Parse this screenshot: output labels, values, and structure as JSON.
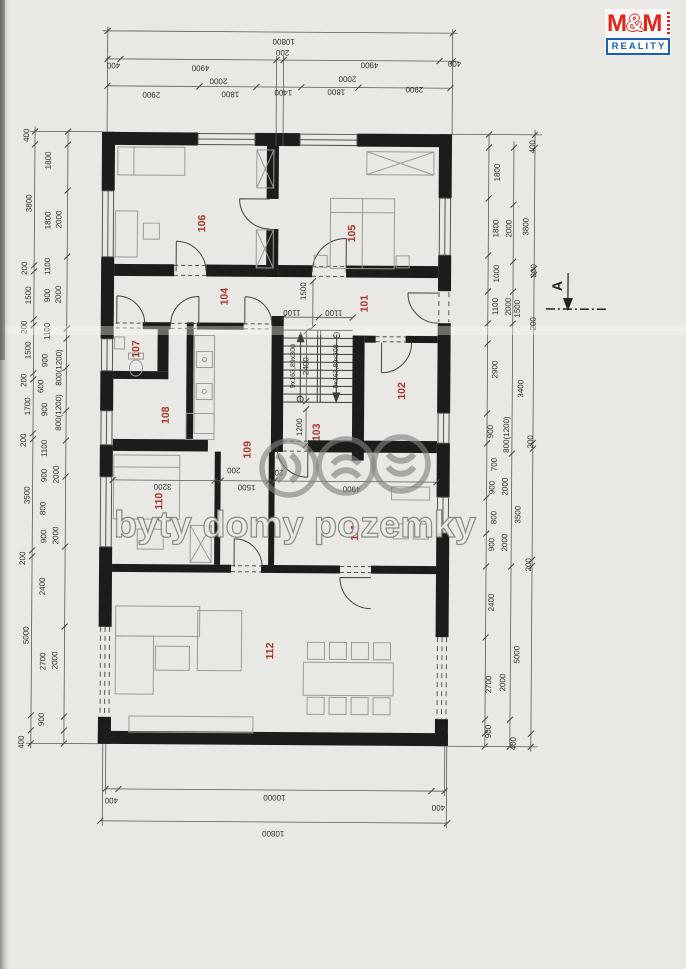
{
  "logo": {
    "brand": "M&M",
    "product": "REALITY"
  },
  "watermark": {
    "text": "byty domy pozemky"
  },
  "section": {
    "label": "A"
  },
  "stairs_note": "9x163,89x300",
  "colors": {
    "wall": "#1c1c1a",
    "room_label": "#a63528",
    "dim_text": "#2e2e2c",
    "brand_red": "#e0251b",
    "brand_blue": "#1b5fb0",
    "watermark_gray": "#8c8c8a",
    "paper": "#e9e8e5"
  },
  "rooms": [
    {
      "n": "101",
      "x": 364,
      "y": 303
    },
    {
      "n": "102",
      "x": 402,
      "y": 390
    },
    {
      "n": "103",
      "x": 317,
      "y": 432
    },
    {
      "n": "104",
      "x": 224,
      "y": 297
    },
    {
      "n": "105",
      "x": 351,
      "y": 233
    },
    {
      "n": "106",
      "x": 201,
      "y": 224
    },
    {
      "n": "107",
      "x": 136,
      "y": 350
    },
    {
      "n": "108",
      "x": 166,
      "y": 416
    },
    {
      "n": "109",
      "x": 248,
      "y": 450
    },
    {
      "n": "110",
      "x": 160,
      "y": 502
    },
    {
      "n": "111",
      "x": 356,
      "y": 532
    },
    {
      "n": "112",
      "x": 272,
      "y": 651
    }
  ],
  "dims": [
    {
      "t": "10800",
      "x": 281,
      "y": 41,
      "r": 180
    },
    {
      "t": "400",
      "x": 111,
      "y": 66,
      "r": 180
    },
    {
      "t": "4900",
      "x": 198,
      "y": 68,
      "r": 180
    },
    {
      "t": "200",
      "x": 280,
      "y": 52,
      "r": 180
    },
    {
      "t": "4900",
      "x": 367,
      "y": 64,
      "r": 180
    },
    {
      "t": "400",
      "x": 452,
      "y": 62,
      "r": 180
    },
    {
      "t": "2900",
      "x": 149,
      "y": 95,
      "r": 180
    },
    {
      "t": "2000",
      "x": 216,
      "y": 81,
      "r": 180
    },
    {
      "t": "1800",
      "x": 228,
      "y": 94,
      "r": 180
    },
    {
      "t": "1400",
      "x": 281,
      "y": 92,
      "r": 180
    },
    {
      "t": "1800",
      "x": 334,
      "y": 91,
      "r": 180
    },
    {
      "t": "2000",
      "x": 345,
      "y": 78,
      "r": 180
    },
    {
      "t": "2900",
      "x": 412,
      "y": 88,
      "r": 180
    },
    {
      "t": "400",
      "x": 114,
      "y": 801,
      "r": 180
    },
    {
      "t": "10000",
      "x": 277,
      "y": 797,
      "r": 180
    },
    {
      "t": "400",
      "x": 441,
      "y": 806,
      "r": 180
    },
    {
      "t": "10800",
      "x": 276,
      "y": 833,
      "r": 180
    },
    {
      "t": "400",
      "x": 25,
      "y": 137,
      "r": -90
    },
    {
      "t": "3800",
      "x": 28,
      "y": 205,
      "r": -90
    },
    {
      "t": "200",
      "x": 24,
      "y": 270,
      "r": -90
    },
    {
      "t": "1500",
      "x": 28,
      "y": 297,
      "r": -90
    },
    {
      "t": "200",
      "x": 24,
      "y": 329,
      "r": -90
    },
    {
      "t": "1500",
      "x": 28,
      "y": 352,
      "r": -90
    },
    {
      "t": "200",
      "x": 24,
      "y": 382,
      "r": -90
    },
    {
      "t": "1700",
      "x": 28,
      "y": 408,
      "r": -90
    },
    {
      "t": "200",
      "x": 24,
      "y": 442,
      "r": -90
    },
    {
      "t": "3500",
      "x": 28,
      "y": 497,
      "r": -90
    },
    {
      "t": "200",
      "x": 24,
      "y": 560,
      "r": -90
    },
    {
      "t": "5000",
      "x": 28,
      "y": 637,
      "r": -90
    },
    {
      "t": "400",
      "x": 24,
      "y": 744,
      "r": -90
    },
    {
      "t": "1800",
      "x": 47,
      "y": 162,
      "r": -90
    },
    {
      "t": "1800",
      "x": 47,
      "y": 222,
      "r": -90
    },
    {
      "t": "2000",
      "x": 58,
      "y": 221,
      "r": -90
    },
    {
      "t": "1100",
      "x": 47,
      "y": 268,
      "r": -90
    },
    {
      "t": "900",
      "x": 47,
      "y": 297,
      "r": -90
    },
    {
      "t": "2000",
      "x": 58,
      "y": 296,
      "r": -90
    },
    {
      "t": "1100",
      "x": 47,
      "y": 333,
      "r": -90
    },
    {
      "t": "900",
      "x": 45,
      "y": 362,
      "r": -90
    },
    {
      "t": "800(1200)",
      "x": 59,
      "y": 369,
      "r": -90
    },
    {
      "t": "600",
      "x": 41,
      "y": 388,
      "r": -90
    },
    {
      "t": "900",
      "x": 45,
      "y": 411,
      "r": -90
    },
    {
      "t": "800(1200)",
      "x": 59,
      "y": 414,
      "r": -90
    },
    {
      "t": "1100",
      "x": 45,
      "y": 450,
      "r": -90
    },
    {
      "t": "900",
      "x": 45,
      "y": 477,
      "r": -90
    },
    {
      "t": "2000",
      "x": 57,
      "y": 476,
      "r": -90
    },
    {
      "t": "800",
      "x": 44,
      "y": 510,
      "r": -90
    },
    {
      "t": "900",
      "x": 45,
      "y": 538,
      "r": -90
    },
    {
      "t": "2000",
      "x": 57,
      "y": 537,
      "r": -90
    },
    {
      "t": "2400",
      "x": 44,
      "y": 588,
      "r": -90
    },
    {
      "t": "2700",
      "x": 45,
      "y": 663,
      "r": -90
    },
    {
      "t": "2000",
      "x": 57,
      "y": 662,
      "r": -90
    },
    {
      "t": "900",
      "x": 44,
      "y": 721,
      "r": -90
    },
    {
      "t": "1800",
      "x": 496,
      "y": 171,
      "r": -90
    },
    {
      "t": "1800",
      "x": 495,
      "y": 227,
      "r": -90
    },
    {
      "t": "1000",
      "x": 496,
      "y": 272,
      "r": -90
    },
    {
      "t": "1100",
      "x": 495,
      "y": 305,
      "r": -90
    },
    {
      "t": "2900",
      "x": 495,
      "y": 368,
      "r": -90
    },
    {
      "t": "900",
      "x": 491,
      "y": 430,
      "r": -90
    },
    {
      "t": "700",
      "x": 495,
      "y": 463,
      "r": -90
    },
    {
      "t": "900",
      "x": 493,
      "y": 486,
      "r": -90
    },
    {
      "t": "800",
      "x": 495,
      "y": 516,
      "r": -90
    },
    {
      "t": "900",
      "x": 493,
      "y": 543,
      "r": -90
    },
    {
      "t": "2400",
      "x": 493,
      "y": 601,
      "r": -90
    },
    {
      "t": "2700",
      "x": 491,
      "y": 683,
      "r": -90
    },
    {
      "t": "900",
      "x": 491,
      "y": 730,
      "r": -90
    },
    {
      "t": "2000",
      "x": 508,
      "y": 227,
      "r": -90
    },
    {
      "t": "2000",
      "x": 508,
      "y": 305,
      "r": -90
    },
    {
      "t": "1500",
      "x": 517,
      "y": 307,
      "r": -90
    },
    {
      "t": "800(1200)",
      "x": 507,
      "y": 433,
      "r": -90
    },
    {
      "t": "2000",
      "x": 506,
      "y": 485,
      "r": -90
    },
    {
      "t": "2000",
      "x": 506,
      "y": 541,
      "r": -90
    },
    {
      "t": "3400",
      "x": 521,
      "y": 387,
      "r": -90
    },
    {
      "t": "3500",
      "x": 519,
      "y": 513,
      "r": -90
    },
    {
      "t": "5000",
      "x": 519,
      "y": 653,
      "r": -90
    },
    {
      "t": "2000",
      "x": 505,
      "y": 681,
      "r": -90
    },
    {
      "t": "400",
      "x": 516,
      "y": 742,
      "r": -90
    },
    {
      "t": "400",
      "x": 531,
      "y": 145,
      "r": -90
    },
    {
      "t": "3800",
      "x": 525,
      "y": 225,
      "r": -90
    },
    {
      "t": "200",
      "x": 533,
      "y": 269,
      "r": -90
    },
    {
      "t": "200",
      "x": 533,
      "y": 322,
      "r": -90
    },
    {
      "t": "200",
      "x": 531,
      "y": 440,
      "r": -90
    },
    {
      "t": "200",
      "x": 530,
      "y": 563,
      "r": -90
    },
    {
      "t": "1500",
      "x": 303,
      "y": 291,
      "r": -90
    },
    {
      "t": "1100",
      "x": 291,
      "y": 312,
      "r": 180
    },
    {
      "t": "1100",
      "x": 333,
      "y": 312,
      "r": 180
    },
    {
      "t": "2400",
      "x": 306,
      "y": 366,
      "r": -90
    },
    {
      "t": "1200",
      "x": 300,
      "y": 427,
      "r": -90
    },
    {
      "t": "200",
      "x": 234,
      "y": 470,
      "r": 180
    },
    {
      "t": "3200",
      "x": 163,
      "y": 487,
      "r": 180
    },
    {
      "t": "1500",
      "x": 247,
      "y": 487,
      "r": 180
    },
    {
      "t": "200",
      "x": 277,
      "y": 472,
      "r": 180
    },
    {
      "t": "4900",
      "x": 352,
      "y": 488,
      "r": 180
    }
  ],
  "stair_notes": [
    {
      "t": "9x163,89x300",
      "x": 293,
      "y": 366,
      "r": -90
    },
    {
      "t": "9x163,89x300",
      "x": 336,
      "y": 366,
      "r": -90
    }
  ]
}
